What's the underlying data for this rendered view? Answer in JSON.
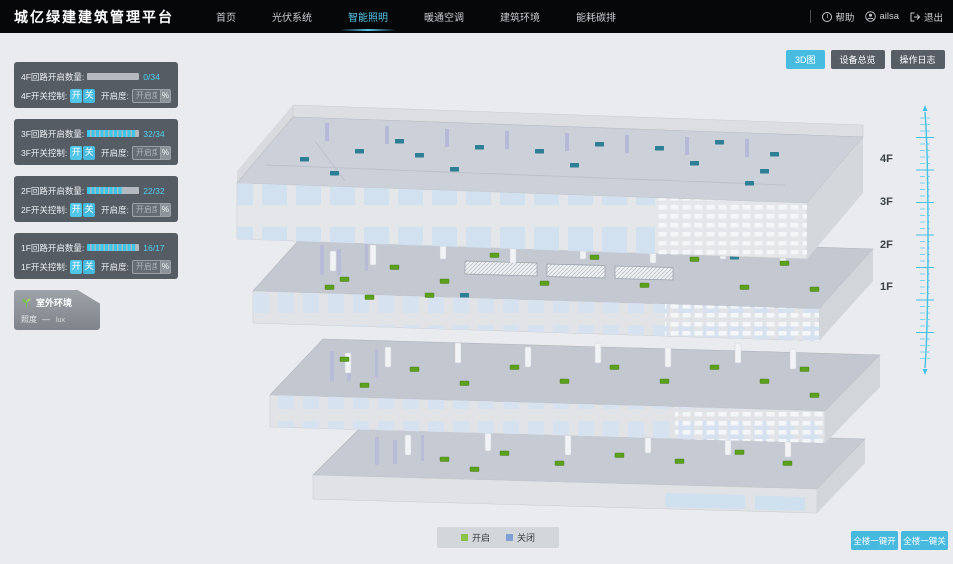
{
  "header": {
    "title": "城亿绿建建筑管理平台",
    "nav": [
      {
        "label": "首页"
      },
      {
        "label": "光伏系统"
      },
      {
        "label": "智能照明"
      },
      {
        "label": "暖通空调"
      },
      {
        "label": "建筑环境"
      },
      {
        "label": "能耗碳排"
      }
    ],
    "help_label": "帮助",
    "username": "ailsa",
    "logout_label": "退出"
  },
  "view_switcher": {
    "map3d": "3D图",
    "device_overview": "设备总览",
    "operation_log": "操作日志"
  },
  "floor_panels": [
    {
      "floor": "4F",
      "circuit_label": "4F回路开启数量:",
      "count": "0/34",
      "progress_pct": 0,
      "switch_label": "4F开关控制:",
      "on_label": "开",
      "off_label": "关",
      "openness_label": "开启度:",
      "openness_placeholder": "开启度",
      "unit_label": "%"
    },
    {
      "floor": "3F",
      "circuit_label": "3F回路开启数量:",
      "count": "32/34",
      "progress_pct": 94,
      "switch_label": "3F开关控制:",
      "on_label": "开",
      "off_label": "关",
      "openness_label": "开启度:",
      "openness_placeholder": "开启度",
      "unit_label": "%"
    },
    {
      "floor": "2F",
      "circuit_label": "2F回路开启数量:",
      "count": "22/32",
      "progress_pct": 69,
      "switch_label": "2F开关控制:",
      "on_label": "开",
      "off_label": "关",
      "openness_label": "开启度:",
      "openness_placeholder": "开启度",
      "unit_label": "%"
    },
    {
      "floor": "1F",
      "circuit_label": "1F回路开启数量:",
      "count": "16/17",
      "progress_pct": 94,
      "switch_label": "1F开关控制:",
      "on_label": "开",
      "off_label": "关",
      "openness_label": "开启度:",
      "openness_placeholder": "开启度",
      "unit_label": "%"
    }
  ],
  "outdoor": {
    "title": "室外环境",
    "metric_label": "照度",
    "metric_value": "—",
    "metric_unit": "lux"
  },
  "floor_axis": {
    "labels": [
      "4F",
      "3F",
      "2F",
      "1F"
    ]
  },
  "legend": {
    "items": [
      {
        "label": "开启",
        "color": "#8bc34a"
      },
      {
        "label": "关闭",
        "color": "#7fa0d4"
      }
    ]
  },
  "bulk_controls": {
    "all_on": "全楼一键开",
    "all_off": "全楼一键关"
  },
  "colors": {
    "accent": "#47bbe0",
    "marker_on": "#5ca11d",
    "marker_off": "#2e7e94"
  }
}
